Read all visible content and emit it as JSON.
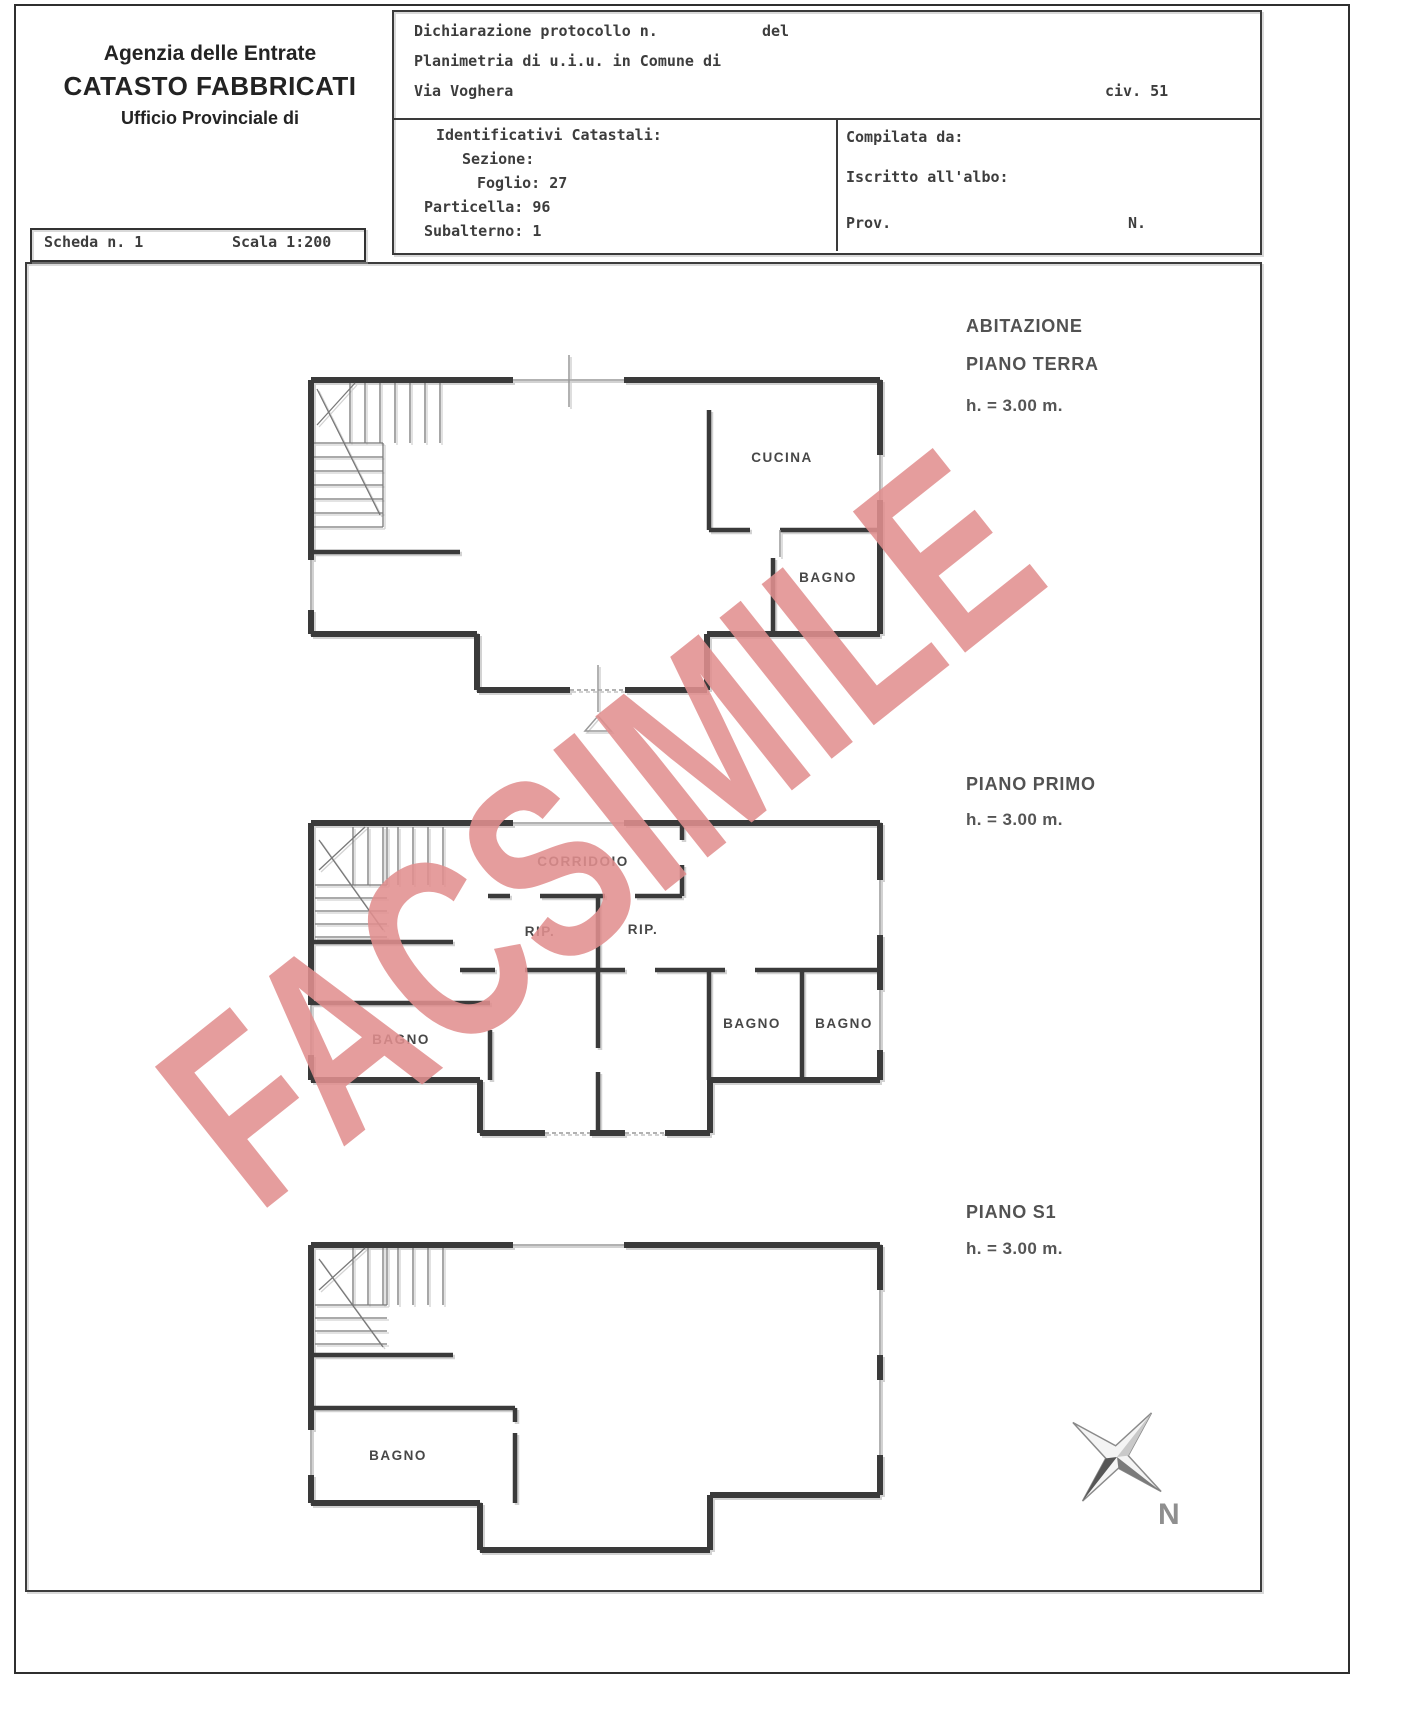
{
  "header": {
    "line1": "Agenzia delle Entrate",
    "line2": "CATASTO FABBRICATI",
    "line3": "Ufficio Provinciale di"
  },
  "scheda": {
    "number": "Scheda n. 1",
    "scale": "Scala 1:200"
  },
  "form": {
    "protocol_label": "Dichiarazione protocollo n.",
    "del_label": "del",
    "planimetria_label": "Planimetria di u.i.u. in Comune di",
    "street": "Via Voghera",
    "civic": "civ. 51",
    "catasto_title": "Identificativi Catastali:",
    "sezione": "Sezione:",
    "foglio": "Foglio: 27",
    "particella": "Particella: 96",
    "subalterno": "Subalterno: 1",
    "compilata": "Compilata da:",
    "iscritto": "Iscritto all'albo:",
    "prov": "Prov.",
    "n_label": "N."
  },
  "floors": {
    "terra": {
      "title": "ABITAZIONE",
      "subtitle": "PIANO TERRA",
      "height": "h. = 3.00 m."
    },
    "primo": {
      "subtitle": "PIANO PRIMO",
      "height": "h. = 3.00 m."
    },
    "s1": {
      "subtitle": "PIANO S1",
      "height": "h. = 3.00 m."
    }
  },
  "rooms": {
    "terra_cucina": "CUCINA",
    "terra_bagno": "BAGNO",
    "primo_corridoio": "CORRIDOIO",
    "primo_rip1": "RIP.",
    "primo_rip2": "RIP.",
    "primo_bagno_left": "BAGNO",
    "primo_bagno_mid": "BAGNO",
    "primo_bagno_right": "BAGNO",
    "s1_bagno": "BAGNO"
  },
  "watermark": {
    "text": "FACSIMILE",
    "color": "#e28f8f"
  },
  "compass": {
    "north": "N"
  },
  "colors": {
    "wall": "#3a3a3a",
    "ink": "#3d3d3d",
    "label": "#4a4a4a",
    "watermark": "#e28f8f"
  }
}
